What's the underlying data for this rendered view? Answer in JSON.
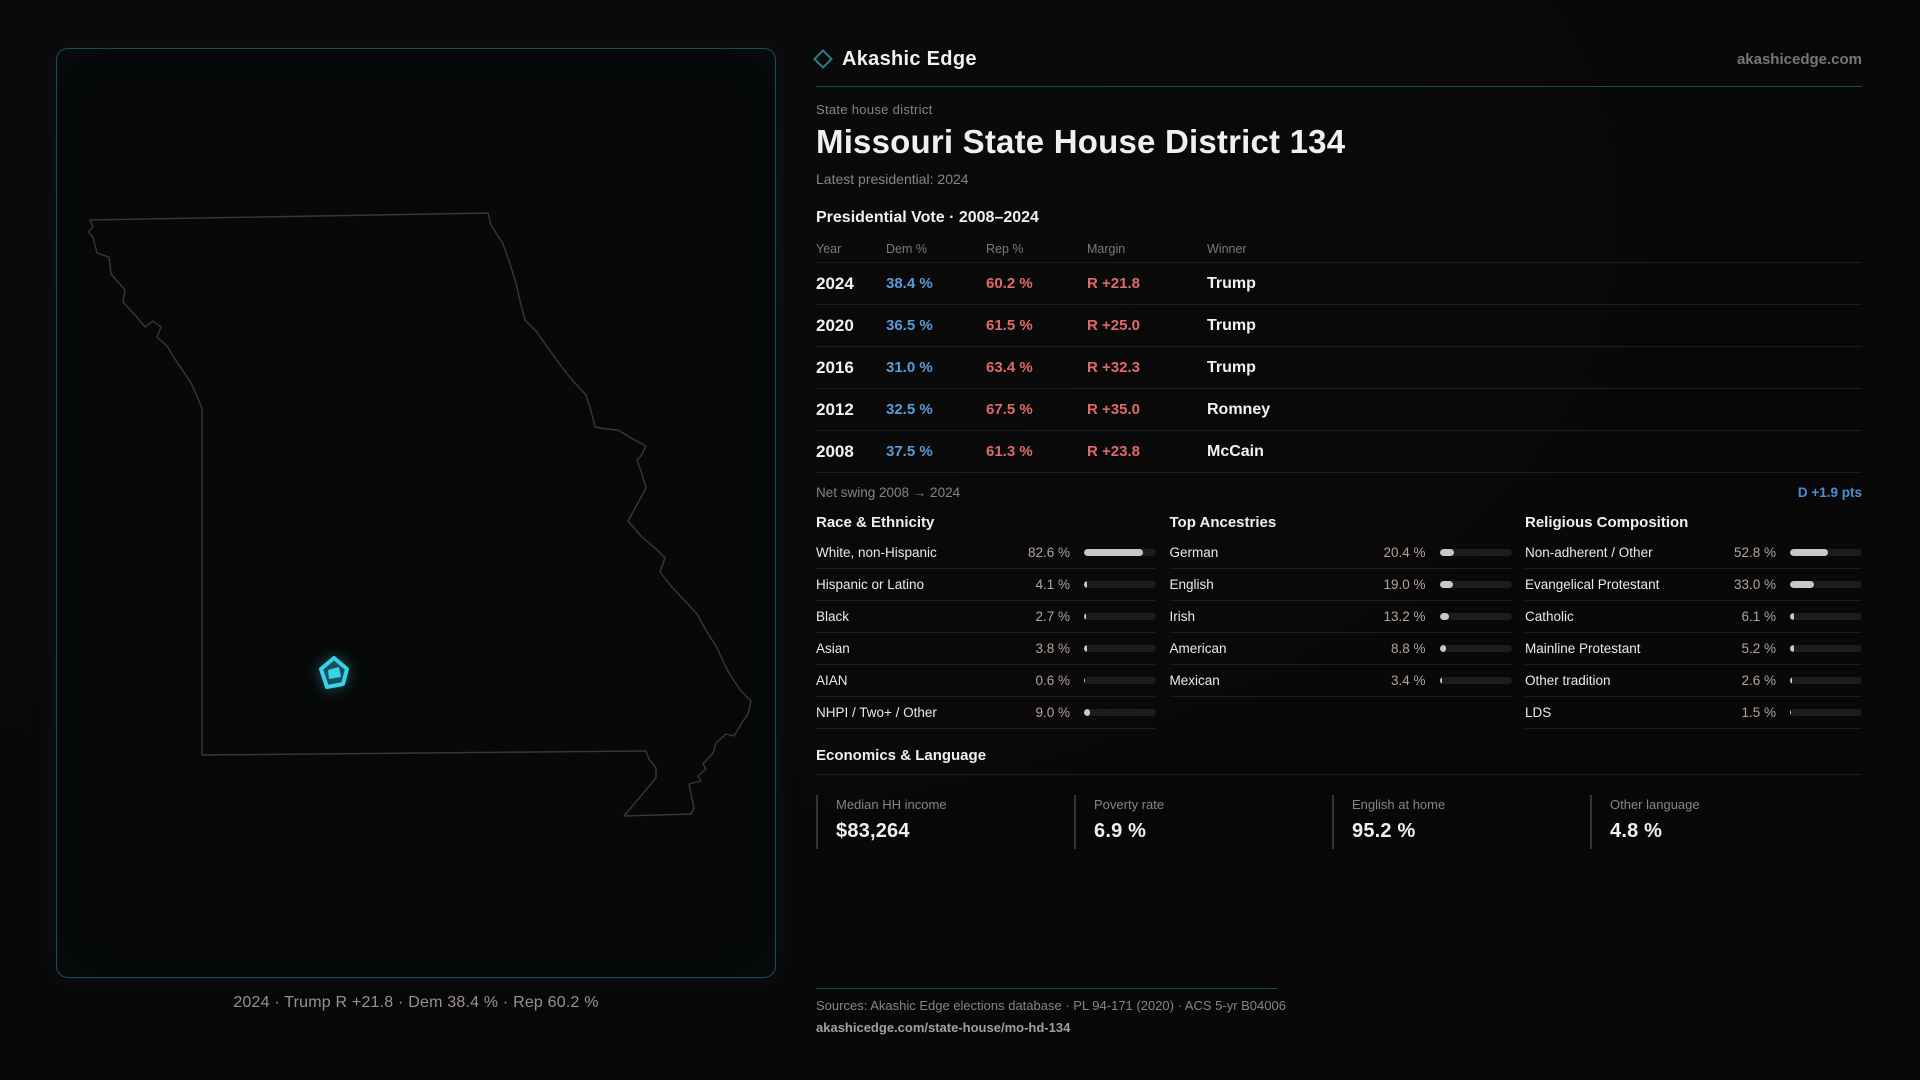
{
  "brand": {
    "name": "Akashic Edge",
    "domain": "akashicedge.com"
  },
  "page": {
    "eyebrow": "State house district",
    "title": "Missouri State House District 134",
    "latest": "Latest presidential: 2024"
  },
  "vote_table": {
    "title": "Presidential Vote · 2008–2024",
    "columns": [
      "Year",
      "Dem %",
      "Rep %",
      "Margin",
      "Winner"
    ],
    "rows": [
      {
        "year": "2024",
        "dem": "38.4 %",
        "rep": "60.2 %",
        "margin": "R +21.8",
        "winner": "Trump"
      },
      {
        "year": "2020",
        "dem": "36.5 %",
        "rep": "61.5 %",
        "margin": "R +25.0",
        "winner": "Trump"
      },
      {
        "year": "2016",
        "dem": "31.0 %",
        "rep": "63.4 %",
        "margin": "R +32.3",
        "winner": "Trump"
      },
      {
        "year": "2012",
        "dem": "32.5 %",
        "rep": "67.5 %",
        "margin": "R +35.0",
        "winner": "Romney"
      },
      {
        "year": "2008",
        "dem": "37.5 %",
        "rep": "61.3 %",
        "margin": "R +23.8",
        "winner": "McCain"
      }
    ],
    "net_swing_label": "Net swing 2008 → 2024",
    "net_swing_value": "D +1.9 pts"
  },
  "chart_data": [
    {
      "type": "bar",
      "title": "Race & Ethnicity",
      "categories": [
        "White, non-Hispanic",
        "Hispanic or Latino",
        "Black",
        "Asian",
        "AIAN",
        "NHPI / Two+ / Other"
      ],
      "values": [
        82.6,
        4.1,
        2.7,
        3.8,
        0.6,
        9.0
      ],
      "unit": "%",
      "xlim": [
        0,
        100
      ]
    },
    {
      "type": "bar",
      "title": "Top Ancestries",
      "categories": [
        "German",
        "English",
        "Irish",
        "American",
        "Mexican"
      ],
      "values": [
        20.4,
        19.0,
        13.2,
        8.8,
        3.4
      ],
      "unit": "%",
      "xlim": [
        0,
        100
      ]
    },
    {
      "type": "bar",
      "title": "Religious Composition",
      "categories": [
        "Non-adherent / Other",
        "Evangelical Protestant",
        "Catholic",
        "Mainline Protestant",
        "Other tradition",
        "LDS"
      ],
      "values": [
        52.8,
        33.0,
        6.1,
        5.2,
        2.6,
        1.5
      ],
      "unit": "%",
      "xlim": [
        0,
        100
      ]
    }
  ],
  "demographics": [
    {
      "title": "Race & Ethnicity",
      "rows": [
        {
          "label": "White, non-Hispanic",
          "value": "82.6 %",
          "pct": 82.6
        },
        {
          "label": "Hispanic or Latino",
          "value": "4.1 %",
          "pct": 4.1
        },
        {
          "label": "Black",
          "value": "2.7 %",
          "pct": 2.7
        },
        {
          "label": "Asian",
          "value": "3.8 %",
          "pct": 3.8
        },
        {
          "label": "AIAN",
          "value": "0.6 %",
          "pct": 0.6
        },
        {
          "label": "NHPI / Two+ / Other",
          "value": "9.0 %",
          "pct": 9.0
        }
      ]
    },
    {
      "title": "Top Ancestries",
      "rows": [
        {
          "label": "German",
          "value": "20.4 %",
          "pct": 20.4
        },
        {
          "label": "English",
          "value": "19.0 %",
          "pct": 19.0
        },
        {
          "label": "Irish",
          "value": "13.2 %",
          "pct": 13.2
        },
        {
          "label": "American",
          "value": "8.8 %",
          "pct": 8.8
        },
        {
          "label": "Mexican",
          "value": "3.4 %",
          "pct": 3.4
        }
      ]
    },
    {
      "title": "Religious Composition",
      "rows": [
        {
          "label": "Non-adherent / Other",
          "value": "52.8 %",
          "pct": 52.8
        },
        {
          "label": "Evangelical Protestant",
          "value": "33.0 %",
          "pct": 33.0
        },
        {
          "label": "Catholic",
          "value": "6.1 %",
          "pct": 6.1
        },
        {
          "label": "Mainline Protestant",
          "value": "5.2 %",
          "pct": 5.2
        },
        {
          "label": "Other tradition",
          "value": "2.6 %",
          "pct": 2.6
        },
        {
          "label": "LDS",
          "value": "1.5 %",
          "pct": 1.5
        }
      ]
    }
  ],
  "economics": {
    "title": "Economics & Language",
    "stats": [
      {
        "label": "Median HH income",
        "value": "$83,264"
      },
      {
        "label": "Poverty rate",
        "value": "6.9 %"
      },
      {
        "label": "English at home",
        "value": "95.2 %"
      },
      {
        "label": "Other language",
        "value": "4.8 %"
      }
    ]
  },
  "map": {
    "caption": "2024 · Trump R +21.8 · Dem 38.4 % · Rep 60.2 %"
  },
  "footer": {
    "sources": "Sources: Akashic Edge elections database · PL 94-171 (2020) · ACS 5-yr B04006",
    "permalink": "akashicedge.com/state-house/mo-hd-134"
  },
  "colors": {
    "dem": "#5b9bd9",
    "rep": "#e06a6a",
    "accent": "#35d0e8",
    "panel_border": "#1c4e57"
  }
}
